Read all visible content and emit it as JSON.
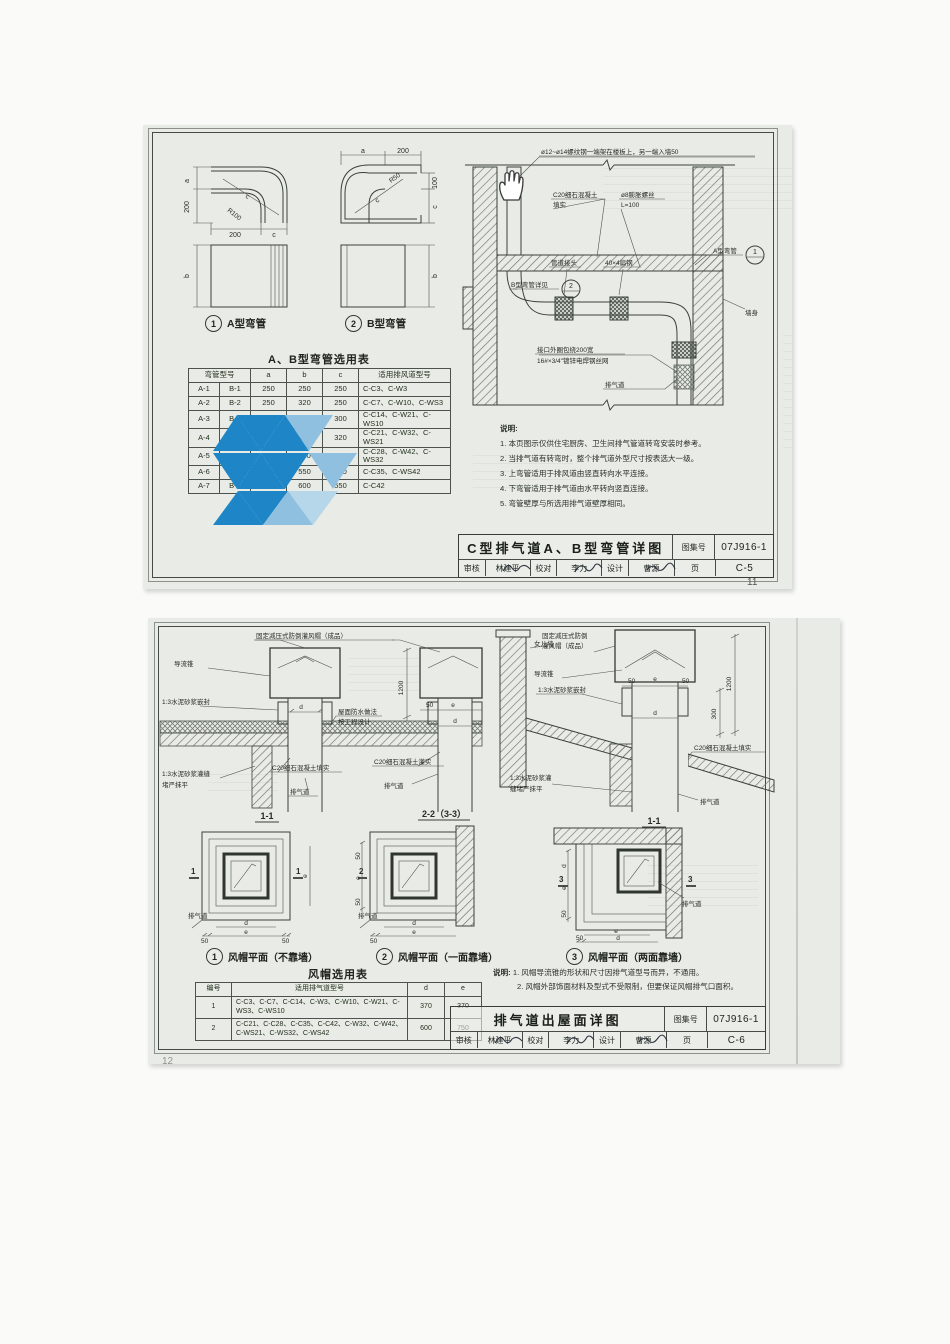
{
  "colors": {
    "paper": "#e9ece6",
    "line": "#39403a",
    "watermark_blue": "#1e86c6",
    "watermark_light": "#8fc0e0"
  },
  "page1": {
    "figures": {
      "fig1_num": "1",
      "fig1_caption": "A型弯管",
      "fig2_num": "2",
      "fig2_caption": "B型弯管",
      "dim_a": "a",
      "dim_b": "b",
      "dim_c": "c",
      "dim_200": "200",
      "dim_100": "100",
      "r100": "R100",
      "r50": "R50"
    },
    "section": {
      "label_rebar": "ø12~ø14螺纹钢一端架在楼板上，另一端入墙50",
      "label_concrete1": "C20细石混凝土",
      "label_concrete2": "填实",
      "label_bolt1": "ø8膨胀螺丝",
      "label_bolt2": "L=100",
      "label_joint": "管道接头",
      "label_flatsteel": "40×4扁钢",
      "label_b_elbow": "B型弯管详见",
      "bubble_b": "2",
      "label_a_elbow": "A型弯管",
      "bubble_a": "1",
      "label_wrap1": "接口外圈包绕200宽",
      "label_wrap2": "16#×3/4\"镀锌电焊钢丝网",
      "label_duct": "排气道",
      "label_wall": "墙身"
    },
    "table": {
      "title": "A、B型弯管选用表",
      "col_model": "弯管型号",
      "col_a": "a",
      "col_b": "b",
      "col_c": "c",
      "col_use": "适用排风道型号",
      "rows": [
        [
          "A-1",
          "B-1",
          "250",
          "250",
          "250",
          "C-C3、C-W3"
        ],
        [
          "A-2",
          "B-2",
          "250",
          "320",
          "250",
          "C-C7、C-W10、C-WS3"
        ],
        [
          "A-3",
          "B-3",
          "300",
          "320",
          "300",
          "C-C14、C-W21、C-WS10"
        ],
        [
          "A-4",
          "B-4",
          "370",
          "400",
          "320",
          "C-C21、C-W32、C-WS21"
        ],
        [
          "A-5",
          "B-5",
          "400",
          "450",
          "400",
          "C-C28、C-W42、C-WS32"
        ],
        [
          "A-6",
          "B-6",
          "450",
          "550",
          "450",
          "C-C35、C-WS42"
        ],
        [
          "A-7",
          "B-7",
          "550",
          "600",
          "550",
          "C-C42"
        ]
      ]
    },
    "notes": {
      "title": "说明:",
      "items": [
        "1. 本页图示仅供住宅厨房、卫生间排气管道转弯安装时参考。",
        "2. 当排气道有转弯时，整个排气道外型尺寸按表选大一级。",
        "3. 上弯管适用于排风道由竖直转向水平连接。",
        "4. 下弯管适用于排气道由水平转向竖直连接。",
        "5. 弯管壁厚与所选用排气道壁厚相同。"
      ]
    },
    "titleblock": {
      "title": "C型排气道A、B型弯管详图",
      "atlas_label": "图集号",
      "atlas_no": "07J916-1",
      "reviewer_label": "审核",
      "reviewer": "林建平",
      "checker_label": "校对",
      "checker": "李力",
      "designer_label": "设计",
      "designer": "曹源",
      "page_label": "页",
      "page_no": "C-5"
    },
    "page_number": "11"
  },
  "page2": {
    "flat": {
      "cap_label": "固定减压式防倒灌风帽（成品）",
      "cone": "导流锥",
      "seal": "1:3水泥砂浆嵌封",
      "roof1": "屋面防水做法",
      "roof2": "按工程设计",
      "grout1": "1:3水泥砂浆灌缝",
      "grout2": "堵严抹平",
      "concrete_l": "C20细石混凝土填实",
      "concrete_r": "C20细石混凝土灌实",
      "duct": "排气道",
      "caption1": "1-1",
      "caption2": "2-2（3-3）",
      "dim_d": "d",
      "dim_e": "e",
      "dim_50": "50",
      "dim_1200": "1200"
    },
    "slope": {
      "parapet": "女儿墙",
      "cone": "导流锥",
      "cap1": "固定减压式防倒",
      "cap2": "灌风帽（成品）",
      "seal": "1:3水泥砂浆嵌封",
      "concrete": "C20细石混凝土填实",
      "grout1": "1:3水泥砂浆灌",
      "grout2": "缝堵严抹平",
      "duct": "排气道",
      "caption": "1-1",
      "dim_50": "50",
      "dim_e": "e",
      "dim_d": "d",
      "dim_1200": "1200",
      "dim_300": "300"
    },
    "plans": {
      "p1_num": "1",
      "p1_caption": "风帽平面（不靠墙）",
      "p2_num": "2",
      "p2_caption": "风帽平面（一面靠墙）",
      "p3_num": "3",
      "p3_caption": "风帽平面（两面靠墙）",
      "duct": "排气道",
      "dim_d": "d",
      "dim_e": "e",
      "dim_50": "50",
      "cut1": "1",
      "cut2": "2",
      "cut3": "3"
    },
    "table": {
      "title": "风帽选用表",
      "col_no": "编号",
      "col_use": "适用排气道型号",
      "col_d": "d",
      "col_e": "e",
      "rows": [
        [
          "1",
          "C-C3、C-C7、C-C14、C-W3、C-W10、C-W21、C-WS3、C-WS10",
          "370",
          "370"
        ],
        [
          "2",
          "C-C21、C-C28、C-C35、C-C42、C-W32、C-W42、C-WS21、C-WS32、C-WS42",
          "600",
          "750"
        ]
      ]
    },
    "notes": {
      "title": "说明:",
      "items": [
        "1. 风帽导流锥的形状和尺寸因排气道型号而异，不通用。",
        "2. 风帽外部饰面材料及型式不受限制，但要保证风帽排气口面积。"
      ]
    },
    "titleblock": {
      "title": "排气道出屋面详图",
      "atlas_label": "图集号",
      "atlas_no": "07J916-1",
      "reviewer_label": "审核",
      "reviewer": "林建平",
      "checker_label": "校对",
      "checker": "李力",
      "designer_label": "设计",
      "designer": "曹源",
      "page_label": "页",
      "page_no": "C-6"
    },
    "page_number": "12"
  }
}
